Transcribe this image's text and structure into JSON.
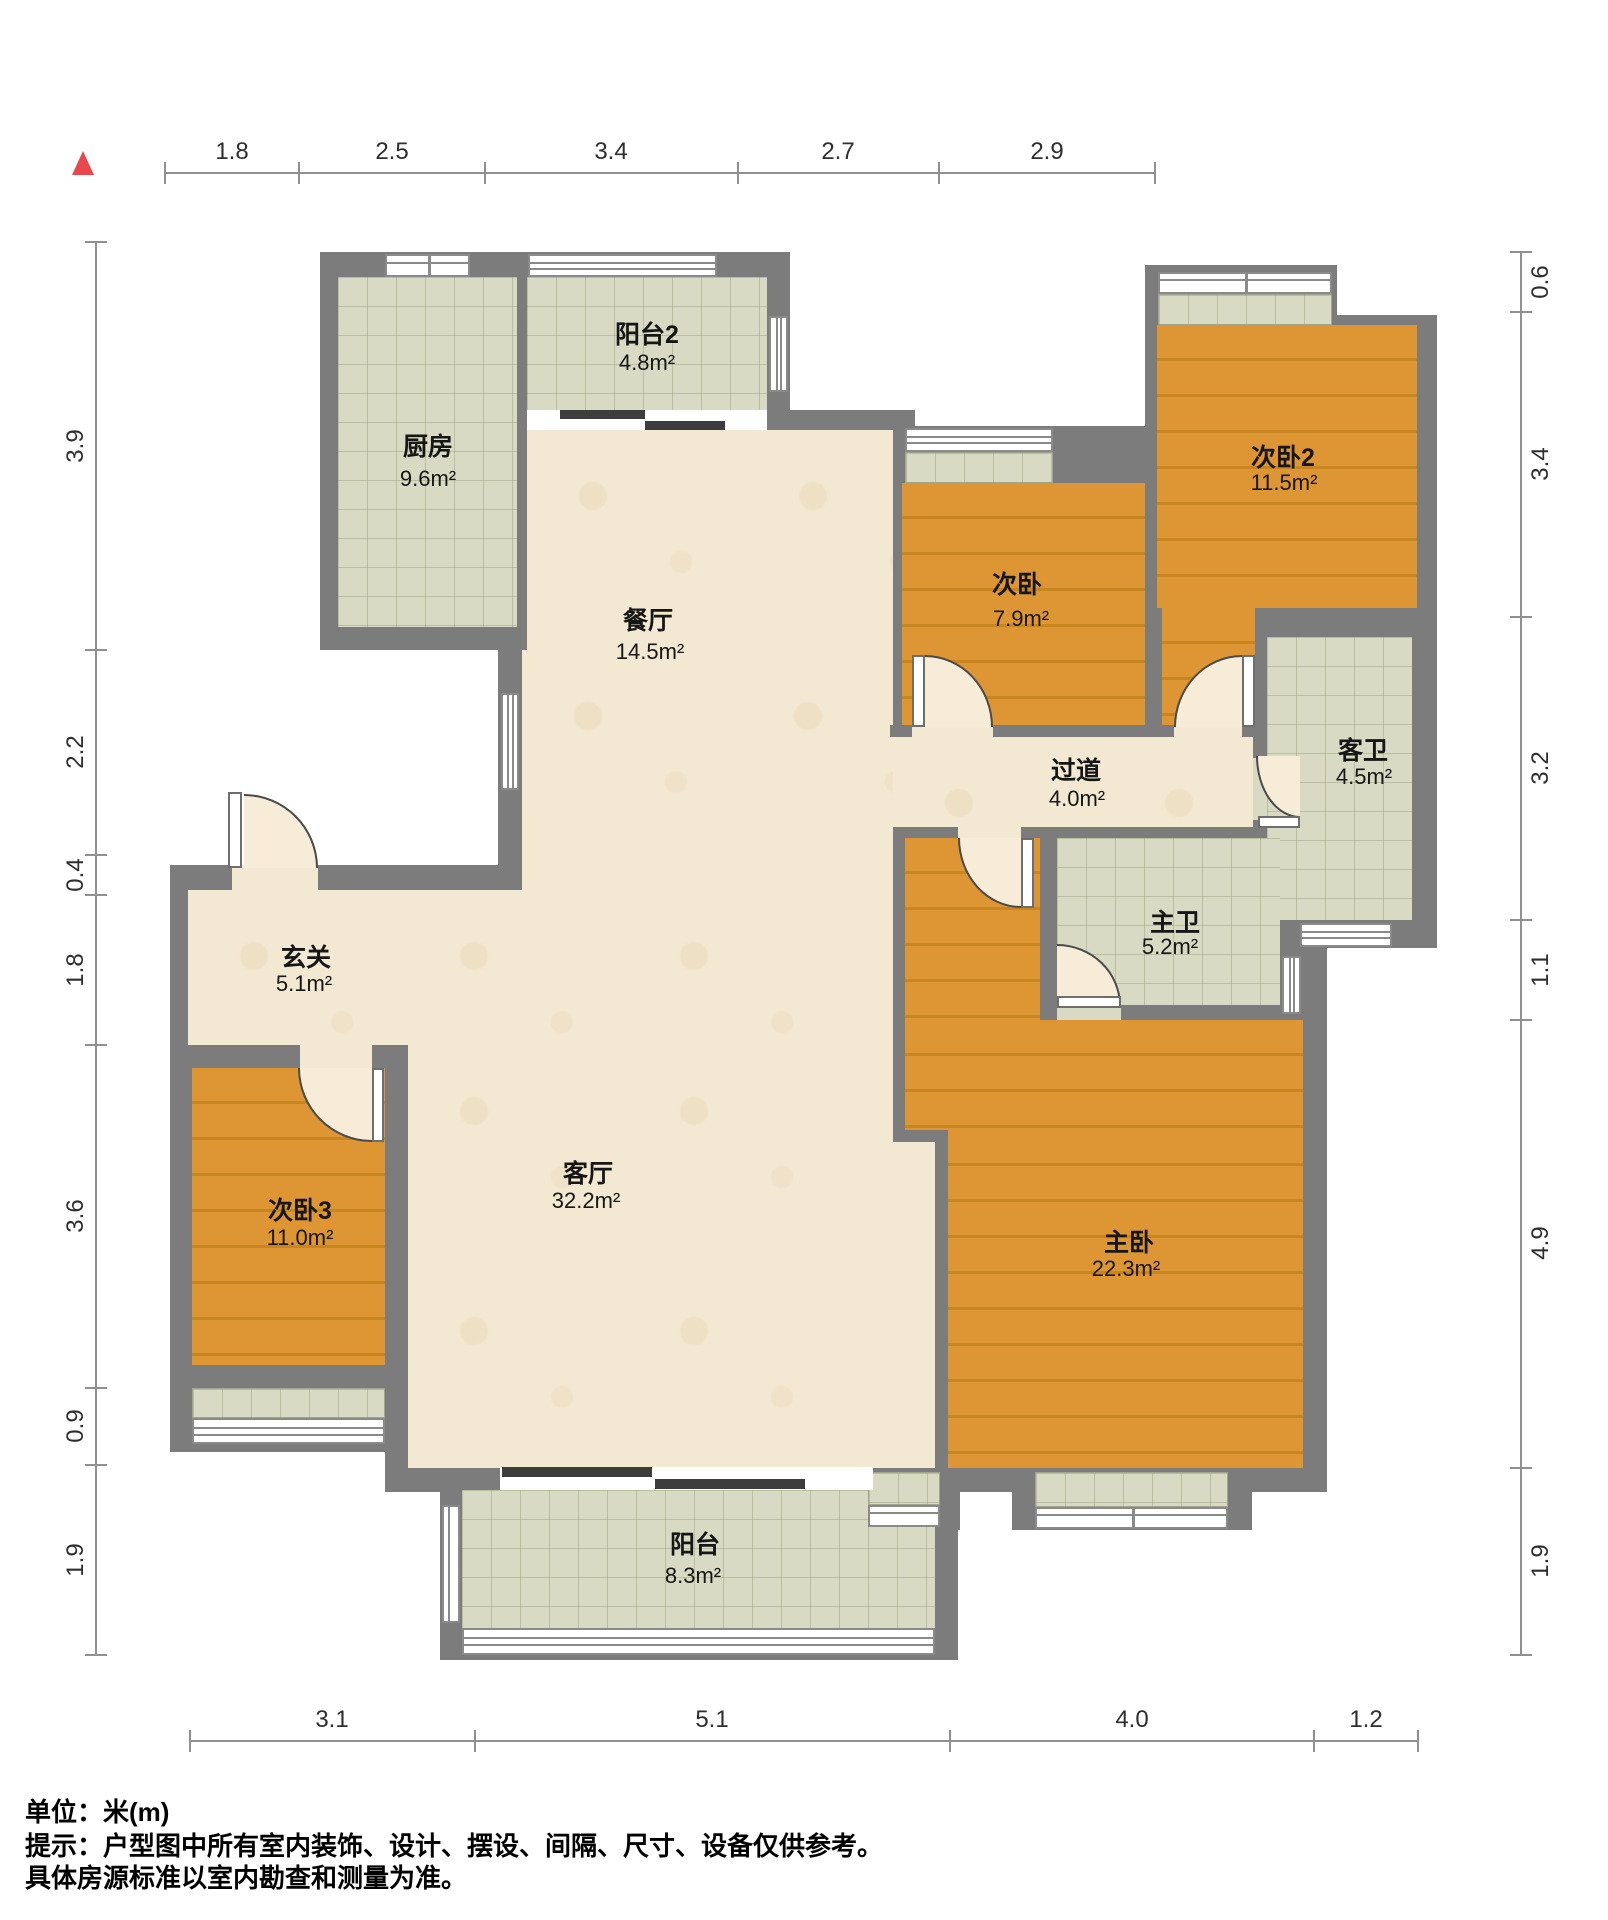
{
  "compass": {
    "icon": "north-triangle",
    "color": "#e8474b"
  },
  "rooms": [
    {
      "name": "阳台2",
      "area": "4.8m²"
    },
    {
      "name": "厨房",
      "area": "9.6m²"
    },
    {
      "name": "餐厅",
      "area": "14.5m²"
    },
    {
      "name": "次卧",
      "area": "7.9m²"
    },
    {
      "name": "次卧2",
      "area": "11.5m²"
    },
    {
      "name": "过道",
      "area": "4.0m²"
    },
    {
      "name": "客卫",
      "area": "4.5m²"
    },
    {
      "name": "主卫",
      "area": "5.2m²"
    },
    {
      "name": "玄关",
      "area": "5.1m²"
    },
    {
      "name": "次卧3",
      "area": "11.0m²"
    },
    {
      "name": "客厅",
      "area": "32.2m²"
    },
    {
      "name": "主卧",
      "area": "22.3m²"
    },
    {
      "name": "阳台",
      "area": "8.3m²"
    }
  ],
  "dimensions": {
    "top": [
      "1.8",
      "2.5",
      "3.4",
      "2.7",
      "2.9"
    ],
    "left": [
      "3.9",
      "2.2",
      "0.4",
      "1.8",
      "3.6",
      "0.9",
      "1.9"
    ],
    "right": [
      "0.6",
      "3.4",
      "3.2",
      "1.1",
      "4.9",
      "1.9"
    ],
    "bottom": [
      "3.1",
      "5.1",
      "4.0",
      "1.2"
    ]
  },
  "footer": {
    "unit": "单位：米(m)",
    "note1": "提示：户型图中所有室内装饰、设计、摆设、间隔、尺寸、设备仅供参考。",
    "note2": "具体房源标准以室内勘查和测量为准。"
  },
  "colors": {
    "wall": "#7c7c7c",
    "wood": "#de9634",
    "tile": "#d8dac3",
    "marble": "#f3e9d2",
    "compass": "#e8474b"
  }
}
